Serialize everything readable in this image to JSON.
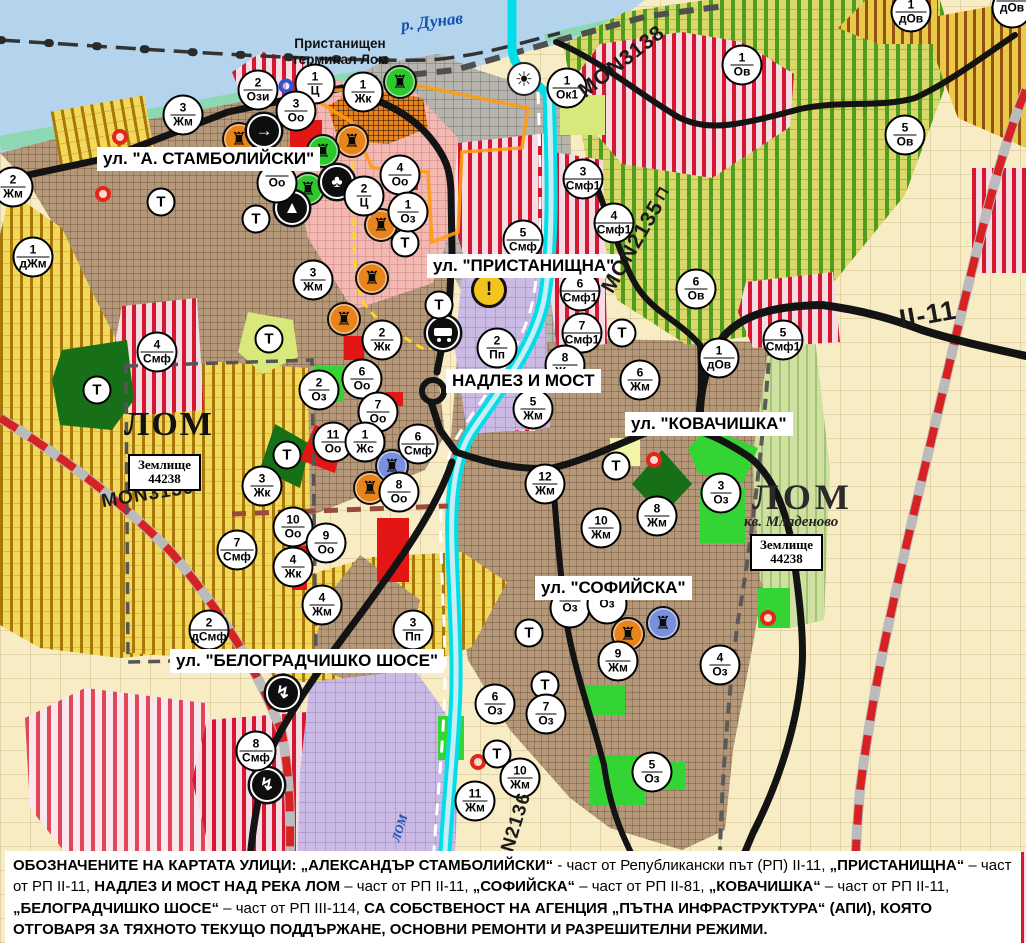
{
  "map": {
    "street_labels": {
      "stamboliyski": "ул. \"А. СТАМБОЛИЙСКИ\"",
      "pristanishtna": "ул. \"ПРИСТАНИЩНА\"",
      "nadlez": "НАДЛЕЗ И МОСТ",
      "kovachishka": "ул. \"КОВАЧИШКА\"",
      "sofiyska": "ул. \"СОФИЙСКА\"",
      "belogradchishko": "ул. \"БЕЛОГРАДЧИШКО ШОСЕ\""
    },
    "road_labels": {
      "mon3138": "MON3138",
      "mon2135": "MON2135",
      "mon3139": "MON3139",
      "mon2136": "MON2136",
      "ii11": "II-11",
      "bridge_symbol": "⊓"
    },
    "place_labels": {
      "terminal": "Пристанищен\nтерминал Лом",
      "lom_west": "ЛОМ",
      "lom_east": "ЛОМ",
      "kvartal": "кв. Младеново",
      "zemlishte_west": "Землище\n44238",
      "zemlishte_east": "Землище\n44238"
    },
    "water_labels": {
      "danube": "р. Дунав",
      "lom_river": "ЛОМ"
    },
    "t_marker_label": "Т",
    "zone_markers": [
      {
        "n": "1",
        "z": "Ц",
        "x": 315,
        "y": 84
      },
      {
        "n": "1",
        "z": "Жк",
        "x": 363,
        "y": 92
      },
      {
        "n": "3",
        "z": "Оо",
        "x": 296,
        "y": 111
      },
      {
        "n": "2",
        "z": "Ози",
        "x": 258,
        "y": 90
      },
      {
        "n": "3",
        "z": "Жм",
        "x": 183,
        "y": 115
      },
      {
        "n": "2",
        "z": "Жм",
        "x": 13,
        "y": 187
      },
      {
        "n": "1",
        "z": "дЖм",
        "x": 33,
        "y": 257
      },
      {
        "n": "4",
        "z": "Оо",
        "x": 400,
        "y": 175
      },
      {
        "n": "",
        "z": "Оо",
        "x": 277,
        "y": 183
      },
      {
        "n": "2",
        "z": "Ц",
        "x": 364,
        "y": 196
      },
      {
        "n": "1",
        "z": "Оз",
        "x": 408,
        "y": 212
      },
      {
        "n": "3",
        "z": "Жм",
        "x": 313,
        "y": 280
      },
      {
        "n": "5",
        "z": "Смф",
        "x": 523,
        "y": 240
      },
      {
        "n": "1",
        "z": "Ок1",
        "x": 567,
        "y": 88
      },
      {
        "n": "1",
        "z": "Ов",
        "x": 742,
        "y": 65
      },
      {
        "n": "5",
        "z": "Ов",
        "x": 905,
        "y": 135
      },
      {
        "n": "1",
        "z": "дОв",
        "x": 911,
        "y": 12
      },
      {
        "n": "",
        "z": "дОв",
        "x": 1012,
        "y": 8
      },
      {
        "n": "3",
        "z": "Смф1",
        "x": 583,
        "y": 179
      },
      {
        "n": "4",
        "z": "Смф1",
        "x": 614,
        "y": 223
      },
      {
        "n": "6",
        "z": "Смф1",
        "x": 580,
        "y": 291
      },
      {
        "n": "7",
        "z": "Смф1",
        "x": 582,
        "y": 333
      },
      {
        "n": "6",
        "z": "Ов",
        "x": 696,
        "y": 289
      },
      {
        "n": "1",
        "z": "дОв",
        "x": 719,
        "y": 358
      },
      {
        "n": "5",
        "z": "Смф1",
        "x": 783,
        "y": 340
      },
      {
        "n": "2",
        "z": "Пп",
        "x": 497,
        "y": 348
      },
      {
        "n": "2",
        "z": "Жк",
        "x": 382,
        "y": 340
      },
      {
        "n": "6",
        "z": "Оо",
        "x": 362,
        "y": 379
      },
      {
        "n": "7",
        "z": "Оо",
        "x": 378,
        "y": 412
      },
      {
        "n": "2",
        "z": "Оз",
        "x": 319,
        "y": 390
      },
      {
        "n": "11",
        "z": "Оо",
        "x": 333,
        "y": 442
      },
      {
        "n": "1",
        "z": "Жс",
        "x": 365,
        "y": 442
      },
      {
        "n": "6",
        "z": "Смф",
        "x": 418,
        "y": 444
      },
      {
        "n": "8",
        "z": "Оо",
        "x": 399,
        "y": 492
      },
      {
        "n": "3",
        "z": "Жк",
        "x": 262,
        "y": 486
      },
      {
        "n": "4",
        "z": "Смф",
        "x": 157,
        "y": 352
      },
      {
        "n": "10",
        "z": "Оо",
        "x": 293,
        "y": 527
      },
      {
        "n": "9",
        "z": "Оо",
        "x": 326,
        "y": 543
      },
      {
        "n": "4",
        "z": "Жк",
        "x": 293,
        "y": 567
      },
      {
        "n": "4",
        "z": "Жм",
        "x": 322,
        "y": 605
      },
      {
        "n": "7",
        "z": "Смф",
        "x": 237,
        "y": 550
      },
      {
        "n": "2",
        "z": "дСмф",
        "x": 209,
        "y": 630
      },
      {
        "n": "3",
        "z": "Пп",
        "x": 413,
        "y": 630
      },
      {
        "n": "8",
        "z": "Смф",
        "x": 256,
        "y": 751
      },
      {
        "n": "8",
        "z": "Жм",
        "x": 565,
        "y": 365
      },
      {
        "n": "5",
        "z": "Жм",
        "x": 533,
        "y": 409
      },
      {
        "n": "6",
        "z": "Жм",
        "x": 640,
        "y": 380
      },
      {
        "n": "12",
        "z": "Жм",
        "x": 545,
        "y": 484
      },
      {
        "n": "10",
        "z": "Жм",
        "x": 601,
        "y": 528
      },
      {
        "n": "8",
        "z": "Жм",
        "x": 657,
        "y": 516
      },
      {
        "n": "3",
        "z": "Оз",
        "x": 721,
        "y": 493
      },
      {
        "n": "9",
        "z": "Жм",
        "x": 618,
        "y": 661
      },
      {
        "n": "4",
        "z": "Оз",
        "x": 720,
        "y": 665
      },
      {
        "n": "",
        "z": "Оз",
        "x": 570,
        "y": 608
      },
      {
        "n": "",
        "z": "Оз",
        "x": 607,
        "y": 604
      },
      {
        "n": "6",
        "z": "Оз",
        "x": 495,
        "y": 704
      },
      {
        "n": "7",
        "z": "Оз",
        "x": 546,
        "y": 714
      },
      {
        "n": "10",
        "z": "Жм",
        "x": 520,
        "y": 778
      },
      {
        "n": "11",
        "z": "Жм",
        "x": 475,
        "y": 801
      },
      {
        "n": "5",
        "z": "Оз",
        "x": 652,
        "y": 772
      }
    ],
    "t_markers": [
      {
        "x": 161,
        "y": 202
      },
      {
        "x": 256,
        "y": 219
      },
      {
        "x": 405,
        "y": 243
      },
      {
        "x": 269,
        "y": 339
      },
      {
        "x": 97,
        "y": 390
      },
      {
        "x": 287,
        "y": 455
      },
      {
        "x": 439,
        "y": 305
      },
      {
        "x": 622,
        "y": 333
      },
      {
        "x": 616,
        "y": 466
      },
      {
        "x": 529,
        "y": 633
      },
      {
        "x": 545,
        "y": 685
      },
      {
        "x": 497,
        "y": 754
      }
    ],
    "poi_icons": [
      {
        "kind": "monument",
        "variant": "orange",
        "x": 239,
        "y": 139
      },
      {
        "kind": "monument",
        "variant": "orange",
        "x": 352,
        "y": 141
      },
      {
        "kind": "monument",
        "variant": "orange",
        "x": 381,
        "y": 225
      },
      {
        "kind": "monument",
        "variant": "orange",
        "x": 372,
        "y": 278
      },
      {
        "kind": "monument",
        "variant": "orange",
        "x": 344,
        "y": 319
      },
      {
        "kind": "monument",
        "variant": "orange",
        "x": 370,
        "y": 488
      },
      {
        "kind": "monument",
        "variant": "orange",
        "x": 628,
        "y": 634
      },
      {
        "kind": "monument",
        "variant": "green",
        "x": 400,
        "y": 82
      },
      {
        "kind": "monument",
        "variant": "green",
        "x": 323,
        "y": 151
      },
      {
        "kind": "monument",
        "variant": "green",
        "x": 308,
        "y": 189
      },
      {
        "kind": "monument",
        "variant": "blue",
        "x": 392,
        "y": 466
      },
      {
        "kind": "monument",
        "variant": "blue",
        "x": 663,
        "y": 623
      },
      {
        "kind": "arrow",
        "x": 264,
        "y": 131
      },
      {
        "kind": "club",
        "x": 337,
        "y": 182
      },
      {
        "kind": "tunnel",
        "x": 292,
        "y": 208
      },
      {
        "kind": "lightning",
        "x": 283,
        "y": 693
      },
      {
        "kind": "lightning",
        "x": 267,
        "y": 785
      },
      {
        "kind": "sun",
        "x": 524,
        "y": 79
      },
      {
        "kind": "warning",
        "x": 489,
        "y": 290
      },
      {
        "kind": "truck",
        "x": 443,
        "y": 333
      },
      {
        "kind": "ring",
        "x": 286,
        "y": 86
      },
      {
        "kind": "reddot",
        "x": 120,
        "y": 137
      },
      {
        "kind": "reddot",
        "x": 103,
        "y": 194
      },
      {
        "kind": "reddot",
        "x": 654,
        "y": 460
      },
      {
        "kind": "reddot",
        "x": 478,
        "y": 762
      },
      {
        "kind": "reddot",
        "x": 768,
        "y": 618
      }
    ],
    "footnote": {
      "segments": [
        {
          "t": "ОБОЗНАЧЕНИТЕ НА КАРТАТА УЛИЦИ: „АЛЕКСАНДЪР СТАМБОЛИЙСКИ“",
          "b": true
        },
        {
          "t": " - част от Републикански път (РП) II-11, ",
          "b": false
        },
        {
          "t": "„ПРИСТАНИЩНА“",
          "b": true
        },
        {
          "t": " – част от РП II-11, ",
          "b": false
        },
        {
          "t": "НАДЛЕЗ И МОСТ НАД РЕКА ЛОМ",
          "b": true
        },
        {
          "t": " – част от РП II-11, ",
          "b": false
        },
        {
          "t": "„СОФИЙСКА“",
          "b": true
        },
        {
          "t": " – част от РП II-81, ",
          "b": false
        },
        {
          "t": "„КОВАЧИШКА“",
          "b": true
        },
        {
          "t": " – част от РП II-11, ",
          "b": false
        },
        {
          "t": "„БЕЛОГРАДЧИШКО ШОСЕ“",
          "b": true
        },
        {
          "t": " – част от РП III-114, ",
          "b": false
        },
        {
          "t": "СА СОБСТВЕНОСТ НА АГЕНЦИЯ „ПЪТНА ИНФРАСТРУКТУРА“ (АПИ), КОЯТО ОТГОВАРЯ ЗА ТЯХНОТО ТЕКУЩО ПОДДЪРЖАНЕ, ОСНОВНИ РЕМОНТИ И РАЗРЕШИТЕЛНИ РЕЖИМИ.",
          "b": true
        }
      ]
    },
    "colors": {
      "water": "#b3d4ec",
      "urban_brown": "#b49879",
      "vineyard_yellow": "#f2d95c",
      "vineyard_stripe": "#a8770a",
      "orchard_green": "#d8d96a",
      "orchard_stripe": "#4f9c1e",
      "mixed_use_stripe": "#d41830",
      "industrial_lavender": "#cabae4",
      "fields": "#f7ecc3",
      "river_cyan": "#00dfe9",
      "road_black": "#131313",
      "railway_red": "#d62222",
      "monument_orange": "#e8841c",
      "monument_green": "#2ec82e",
      "monument_blue": "#7a90dc",
      "label_blue": "#1550b0"
    }
  }
}
